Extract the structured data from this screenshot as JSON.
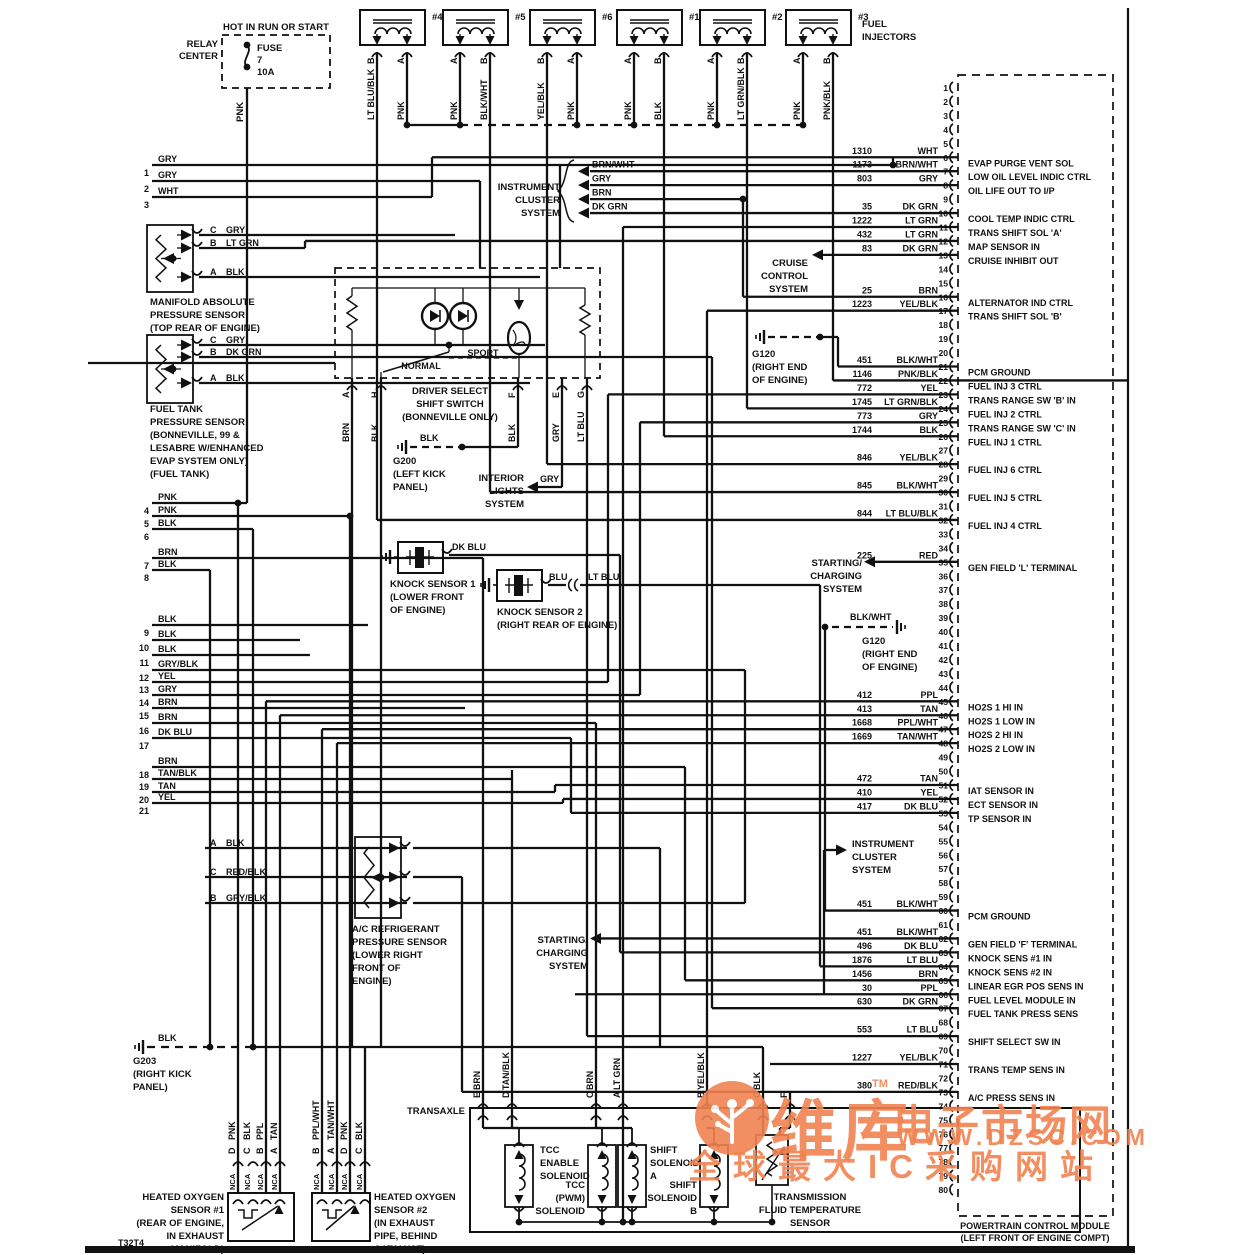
{
  "diagram_code": "T32T4",
  "relay": {
    "header": "HOT IN RUN OR START",
    "name": [
      "RELAY",
      "CENTER"
    ],
    "fuse": [
      "FUSE",
      "7",
      "10A"
    ],
    "wire": "PNK"
  },
  "injectors": {
    "group_label": [
      "FUEL",
      "INJECTORS"
    ],
    "items": [
      {
        "id": "#4",
        "pins": [
          {
            "pin": "B",
            "color": "LT BLU/BLK"
          },
          {
            "pin": "A",
            "color": "PNK"
          }
        ]
      },
      {
        "id": "#5",
        "pins": [
          {
            "pin": "A",
            "color": "PNK"
          },
          {
            "pin": "B",
            "color": "BLK/WHT"
          }
        ]
      },
      {
        "id": "#6",
        "pins": [
          {
            "pin": "B",
            "color": "YEL/BLK"
          },
          {
            "pin": "A",
            "color": "PNK"
          }
        ]
      },
      {
        "id": "#1",
        "pins": [
          {
            "pin": "A",
            "color": "PNK"
          },
          {
            "pin": "B",
            "color": "BLK"
          }
        ]
      },
      {
        "id": "#2",
        "pins": [
          {
            "pin": "A",
            "color": "PNK"
          },
          {
            "pin": "B",
            "color": "LT GRN/BLK"
          }
        ]
      },
      {
        "id": "#3",
        "pins": [
          {
            "pin": "A",
            "color": "PNK"
          },
          {
            "pin": "B",
            "color": "PNK/BLK"
          }
        ]
      }
    ]
  },
  "left_wires": [
    {
      "n": "1",
      "color": "GRY"
    },
    {
      "n": "2",
      "color": "GRY"
    },
    {
      "n": "3",
      "color": "WHT"
    },
    {
      "n": "4",
      "color": "PNK"
    },
    {
      "n": "5",
      "color": "PNK"
    },
    {
      "n": "6",
      "color": "BLK"
    },
    {
      "n": "7",
      "color": "BRN"
    },
    {
      "n": "8",
      "color": "BLK"
    },
    {
      "n": "9",
      "color": "BLK"
    },
    {
      "n": "10",
      "color": "BLK"
    },
    {
      "n": "11",
      "color": "BLK"
    },
    {
      "n": "12",
      "color": "GRY/BLK"
    },
    {
      "n": "13",
      "color": "YEL"
    },
    {
      "n": "14",
      "color": "GRY"
    },
    {
      "n": "15",
      "color": "BRN"
    },
    {
      "n": "16",
      "color": "BRN"
    },
    {
      "n": "17",
      "color": "DK BLU"
    },
    {
      "n": "18",
      "color": "BRN"
    },
    {
      "n": "19",
      "color": "TAN/BLK"
    },
    {
      "n": "20",
      "color": "TAN"
    },
    {
      "n": "21",
      "color": "YEL"
    }
  ],
  "pcm": {
    "footer": [
      "POWERTRAIN CONTROL MODULE",
      "(LEFT FRONT OF ENGINE COMPT)"
    ],
    "pin_count": 80,
    "pins": [
      {
        "n": 6,
        "wire": "1310",
        "color": "WHT",
        "label": "EVAP PURGE VENT SOL"
      },
      {
        "n": 7,
        "wire": "1173",
        "color": "BRN/WHT",
        "label": "LOW OIL LEVEL INDIC CTRL"
      },
      {
        "n": 8,
        "wire": "803",
        "color": "GRY",
        "label": "OIL LIFE OUT TO I/P"
      },
      {
        "n": 10,
        "wire": "35",
        "color": "DK GRN",
        "label": "COOL TEMP INDIC CTRL"
      },
      {
        "n": 11,
        "wire": "1222",
        "color": "LT GRN",
        "label": "TRANS SHIFT SOL 'A'"
      },
      {
        "n": 12,
        "wire": "432",
        "color": "LT GRN",
        "label": "MAP SENSOR IN"
      },
      {
        "n": 13,
        "wire": "83",
        "color": "DK GRN",
        "label": "CRUISE INHIBIT OUT"
      },
      {
        "n": 16,
        "wire": "25",
        "color": "BRN",
        "label": "ALTERNATOR IND CTRL"
      },
      {
        "n": 17,
        "wire": "1223",
        "color": "YEL/BLK",
        "label": "TRANS SHIFT SOL 'B'"
      },
      {
        "n": 21,
        "wire": "451",
        "color": "BLK/WHT",
        "label": "PCM GROUND"
      },
      {
        "n": 22,
        "wire": "1146",
        "color": "PNK/BLK",
        "label": "FUEL INJ 3 CTRL"
      },
      {
        "n": 23,
        "wire": "772",
        "color": "YEL",
        "label": "TRANS RANGE SW 'B' IN"
      },
      {
        "n": 24,
        "wire": "1745",
        "color": "LT GRN/BLK",
        "label": "FUEL INJ 2 CTRL"
      },
      {
        "n": 25,
        "wire": "773",
        "color": "GRY",
        "label": "TRANS RANGE SW 'C' IN"
      },
      {
        "n": 26,
        "wire": "1744",
        "color": "BLK",
        "label": "FUEL INJ 1 CTRL"
      },
      {
        "n": 28,
        "wire": "846",
        "color": "YEL/BLK",
        "label": "FUEL INJ 6 CTRL"
      },
      {
        "n": 30,
        "wire": "845",
        "color": "BLK/WHT",
        "label": "FUEL INJ 5 CTRL"
      },
      {
        "n": 32,
        "wire": "844",
        "color": "LT BLU/BLK",
        "label": "FUEL INJ 4 CTRL"
      },
      {
        "n": 35,
        "wire": "225",
        "color": "RED",
        "label": "GEN FIELD 'L' TERMINAL"
      },
      {
        "n": 45,
        "wire": "412",
        "color": "PPL",
        "label": "HO2S 1 HI IN"
      },
      {
        "n": 46,
        "wire": "413",
        "color": "TAN",
        "label": "HO2S 1 LOW IN"
      },
      {
        "n": 47,
        "wire": "1668",
        "color": "PPL/WHT",
        "label": "HO2S 2 HI IN"
      },
      {
        "n": 48,
        "wire": "1669",
        "color": "TAN/WHT",
        "label": "HO2S 2 LOW IN"
      },
      {
        "n": 51,
        "wire": "472",
        "color": "TAN",
        "label": "IAT SENSOR IN"
      },
      {
        "n": 52,
        "wire": "410",
        "color": "YEL",
        "label": "ECT SENSOR IN"
      },
      {
        "n": 53,
        "wire": "417",
        "color": "DK BLU",
        "label": "TP SENSOR IN"
      },
      {
        "n": 60,
        "wire": "451",
        "color": "BLK/WHT",
        "label": "PCM GROUND"
      },
      {
        "n": 62,
        "wire": "451",
        "color": "BLK/WHT",
        "label": "GEN FIELD 'F' TERMINAL"
      },
      {
        "n": 63,
        "wire": "496",
        "color": "DK BLU",
        "label": "KNOCK SENS #1 IN"
      },
      {
        "n": 64,
        "wire": "1876",
        "color": "LT BLU",
        "label": "KNOCK SENS #2 IN"
      },
      {
        "n": 65,
        "wire": "1456",
        "color": "BRN",
        "label": "LINEAR EGR POS SENS IN"
      },
      {
        "n": 66,
        "wire": "30",
        "color": "PPL",
        "label": "FUEL LEVEL MODULE IN"
      },
      {
        "n": 67,
        "wire": "630",
        "color": "DK GRN",
        "label": "FUEL TANK PRESS SENS"
      },
      {
        "n": 69,
        "wire": "553",
        "color": "LT BLU",
        "label": "SHIFT SELECT SW IN"
      },
      {
        "n": 71,
        "wire": "1227",
        "color": "YEL/BLK",
        "label": "TRANS TEMP SENS IN"
      },
      {
        "n": 73,
        "wire": "380",
        "color": "RED/BLK",
        "label": "A/C PRESS SENS IN"
      }
    ]
  },
  "sensors": {
    "map": {
      "label": [
        "MANIFOLD ABSOLUTE",
        "PRESSURE SENSOR",
        "(TOP REAR OF ENGINE)"
      ],
      "pins": [
        {
          "pin": "C",
          "color": "GRY"
        },
        {
          "pin": "B",
          "color": "LT GRN"
        },
        {
          "pin": "A",
          "color": "BLK"
        }
      ]
    },
    "fuel_tank": {
      "label": [
        "FUEL TANK",
        "PRESSURE SENSOR",
        "(BONNEVILLE, 99 &",
        "LESABRE W/ENHANCED",
        "EVAP SYSTEM ONLY)",
        "(FUEL TANK)"
      ],
      "pins": [
        {
          "pin": "C",
          "color": "GRY"
        },
        {
          "pin": "B",
          "color": "DK GRN"
        },
        {
          "pin": "A",
          "color": "BLK"
        }
      ]
    },
    "ac": {
      "label": [
        "A/C REFRIGERANT",
        "PRESSURE SENSOR",
        "(LOWER RIGHT",
        "FRONT OF",
        "ENGINE)"
      ],
      "pins": [
        {
          "pin": "A",
          "color": "BLK"
        },
        {
          "pin": "C",
          "color": "RED/BLK"
        },
        {
          "pin": "B",
          "color": "GRY/BLK"
        }
      ]
    },
    "knock1": {
      "label": [
        "KNOCK SENSOR 1",
        "(LOWER FRONT",
        "OF ENGINE)"
      ],
      "wire": "DK BLU"
    },
    "knock2": {
      "label": [
        "KNOCK SENSOR 2",
        "(RIGHT REAR OF ENGINE)"
      ],
      "wire_a": "BLU",
      "wire_b": "LT BLU"
    },
    "ho2s1": {
      "label": [
        "HEATED OXYGEN",
        "SENSOR #1",
        "(REAR OF ENGINE,",
        "IN EXHAUST",
        "MANIFOLD)"
      ],
      "nca": "NCA",
      "pins": [
        {
          "pin": "D",
          "color": "PNK"
        },
        {
          "pin": "C",
          "color": "BLK"
        },
        {
          "pin": "B",
          "color": "PPL"
        },
        {
          "pin": "A",
          "color": "TAN"
        }
      ]
    },
    "ho2s2": {
      "label": [
        "HEATED OXYGEN",
        "SENSOR #2",
        "(IN EXHAUST",
        "PIPE, BEHIND",
        "CATALYST)"
      ],
      "nca": "NCA",
      "pins": [
        {
          "pin": "B",
          "color": "PPL/WHT"
        },
        {
          "pin": "A",
          "color": "TAN/WHT"
        },
        {
          "pin": "D",
          "color": "PNK"
        },
        {
          "pin": "C",
          "color": "BLK"
        }
      ]
    }
  },
  "shift_switch": {
    "label": [
      "DRIVER SELECT",
      "SHIFT SWITCH",
      "(BONNEVILLE ONLY)"
    ],
    "modes": {
      "normal": "NORMAL",
      "sport": "SPORT"
    },
    "pins": [
      {
        "pin": "A",
        "color": "BRN"
      },
      {
        "pin": "H",
        "color": "BLK"
      },
      {
        "pin": "F",
        "color": "BLK"
      },
      {
        "pin": "E",
        "color": "GRY"
      },
      {
        "pin": "G",
        "color": "LT BLU"
      }
    ]
  },
  "grounds": {
    "g200": {
      "name": "G200",
      "loc": [
        "(LEFT KICK",
        "PANEL)"
      ],
      "wire": "BLK"
    },
    "g120a": {
      "name": "G120",
      "loc": [
        "(RIGHT END",
        "OF ENGINE)"
      ]
    },
    "g120b": {
      "name": "G120",
      "loc": [
        "(RIGHT END",
        "OF ENGINE)"
      ],
      "wire": "BLK/WHT"
    },
    "g203": {
      "name": "G203",
      "loc": [
        "(RIGHT KICK",
        "PANEL)"
      ],
      "wire": "BLK"
    }
  },
  "systems": {
    "instrument1": {
      "label": [
        "INSTRUMENT",
        "CLUSTER",
        "SYSTEM"
      ],
      "wires": [
        "BRN/WHT",
        "GRY",
        "BRN",
        "DK GRN"
      ]
    },
    "instrument2": {
      "label": [
        "INSTRUMENT",
        "CLUSTER",
        "SYSTEM"
      ]
    },
    "cruise": {
      "label": [
        "CRUISE",
        "CONTROL",
        "SYSTEM"
      ]
    },
    "starting1": {
      "label": [
        "STARTING/",
        "CHARGING",
        "SYSTEM"
      ]
    },
    "starting2": {
      "label": [
        "STARTING/",
        "CHARGING",
        "SYSTEM"
      ]
    },
    "interior": {
      "label": [
        "INTERIOR",
        "LIGHTS",
        "SYSTEM"
      ],
      "wire": "GRY"
    }
  },
  "transaxle": {
    "label": "TRANSAXLE",
    "pins": [
      {
        "pin": "E",
        "color": "BRN"
      },
      {
        "pin": "D",
        "color": "TAN/BLK"
      },
      {
        "pin": "C",
        "color": "BRN"
      },
      {
        "pin": "A",
        "color": "LT GRN"
      },
      {
        "pin": "B",
        "color": "YEL/BLK"
      },
      {
        "pin": "G",
        "color": "BLK"
      },
      {
        "pin": "F",
        "color": ""
      }
    ],
    "components": {
      "tcc_enable": [
        "TCC",
        "ENABLE",
        "SOLENOID"
      ],
      "tcc_pwm": [
        "TCC",
        "(PWM)",
        "SOLENOID"
      ],
      "shift_a": [
        "SHIFT",
        "SOLENOID",
        "A"
      ],
      "shift_b": [
        "SHIFT",
        "SOLENOID",
        "B"
      ],
      "temp": [
        "TRANSMISSION",
        "FLUID TEMPERATURE",
        "SENSOR"
      ]
    }
  },
  "watermark": {
    "brand": "维库",
    "suffix": "电子市场网",
    "tm": "TM",
    "url": "WWW.DZSC.COM",
    "tagline": "全球最大IC采购网站",
    "color": "#f08352"
  }
}
